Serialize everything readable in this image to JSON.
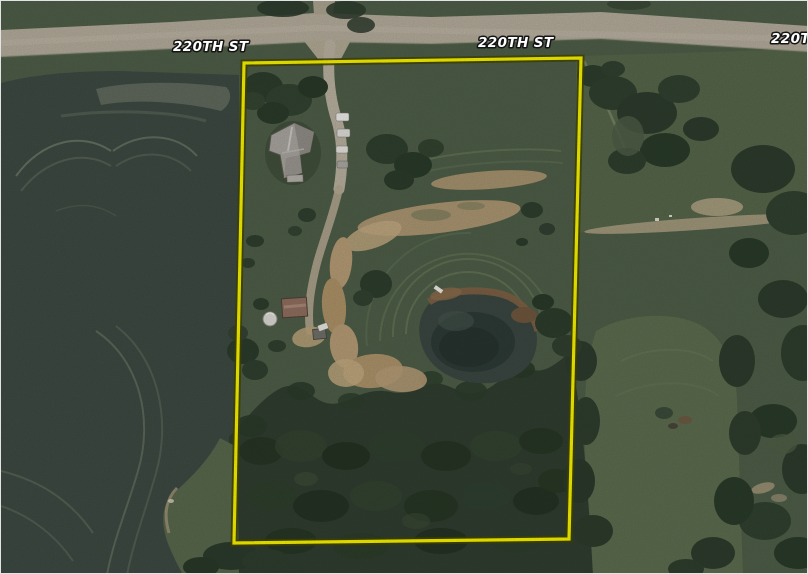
{
  "map": {
    "type": "aerial-satellite-parcel-view",
    "road_labels": [
      {
        "text": "220TH ST"
      },
      {
        "text": "220TH ST"
      },
      {
        "text": "220TH ST"
      }
    ],
    "boundary": {
      "stroke": "#f4f000",
      "outline": "#454500",
      "points": "243,62 580,57 568,538 233,542"
    },
    "palette": {
      "pasture": "#4d5d47",
      "field": "#3d4942",
      "road": "#b2aa9a",
      "dirt": "#b49a74",
      "forest": "#2f3d2f",
      "pond": "#3a4641",
      "house_roof": "#a7a39d",
      "shed_roof": "#8e6e5e"
    },
    "features": [
      "gravel-road",
      "tilled-field",
      "lawn",
      "house",
      "driveway",
      "parked-vehicles",
      "shed",
      "round-tank",
      "pond",
      "dirt-paths",
      "woods",
      "tree-clusters",
      "pasture"
    ]
  }
}
